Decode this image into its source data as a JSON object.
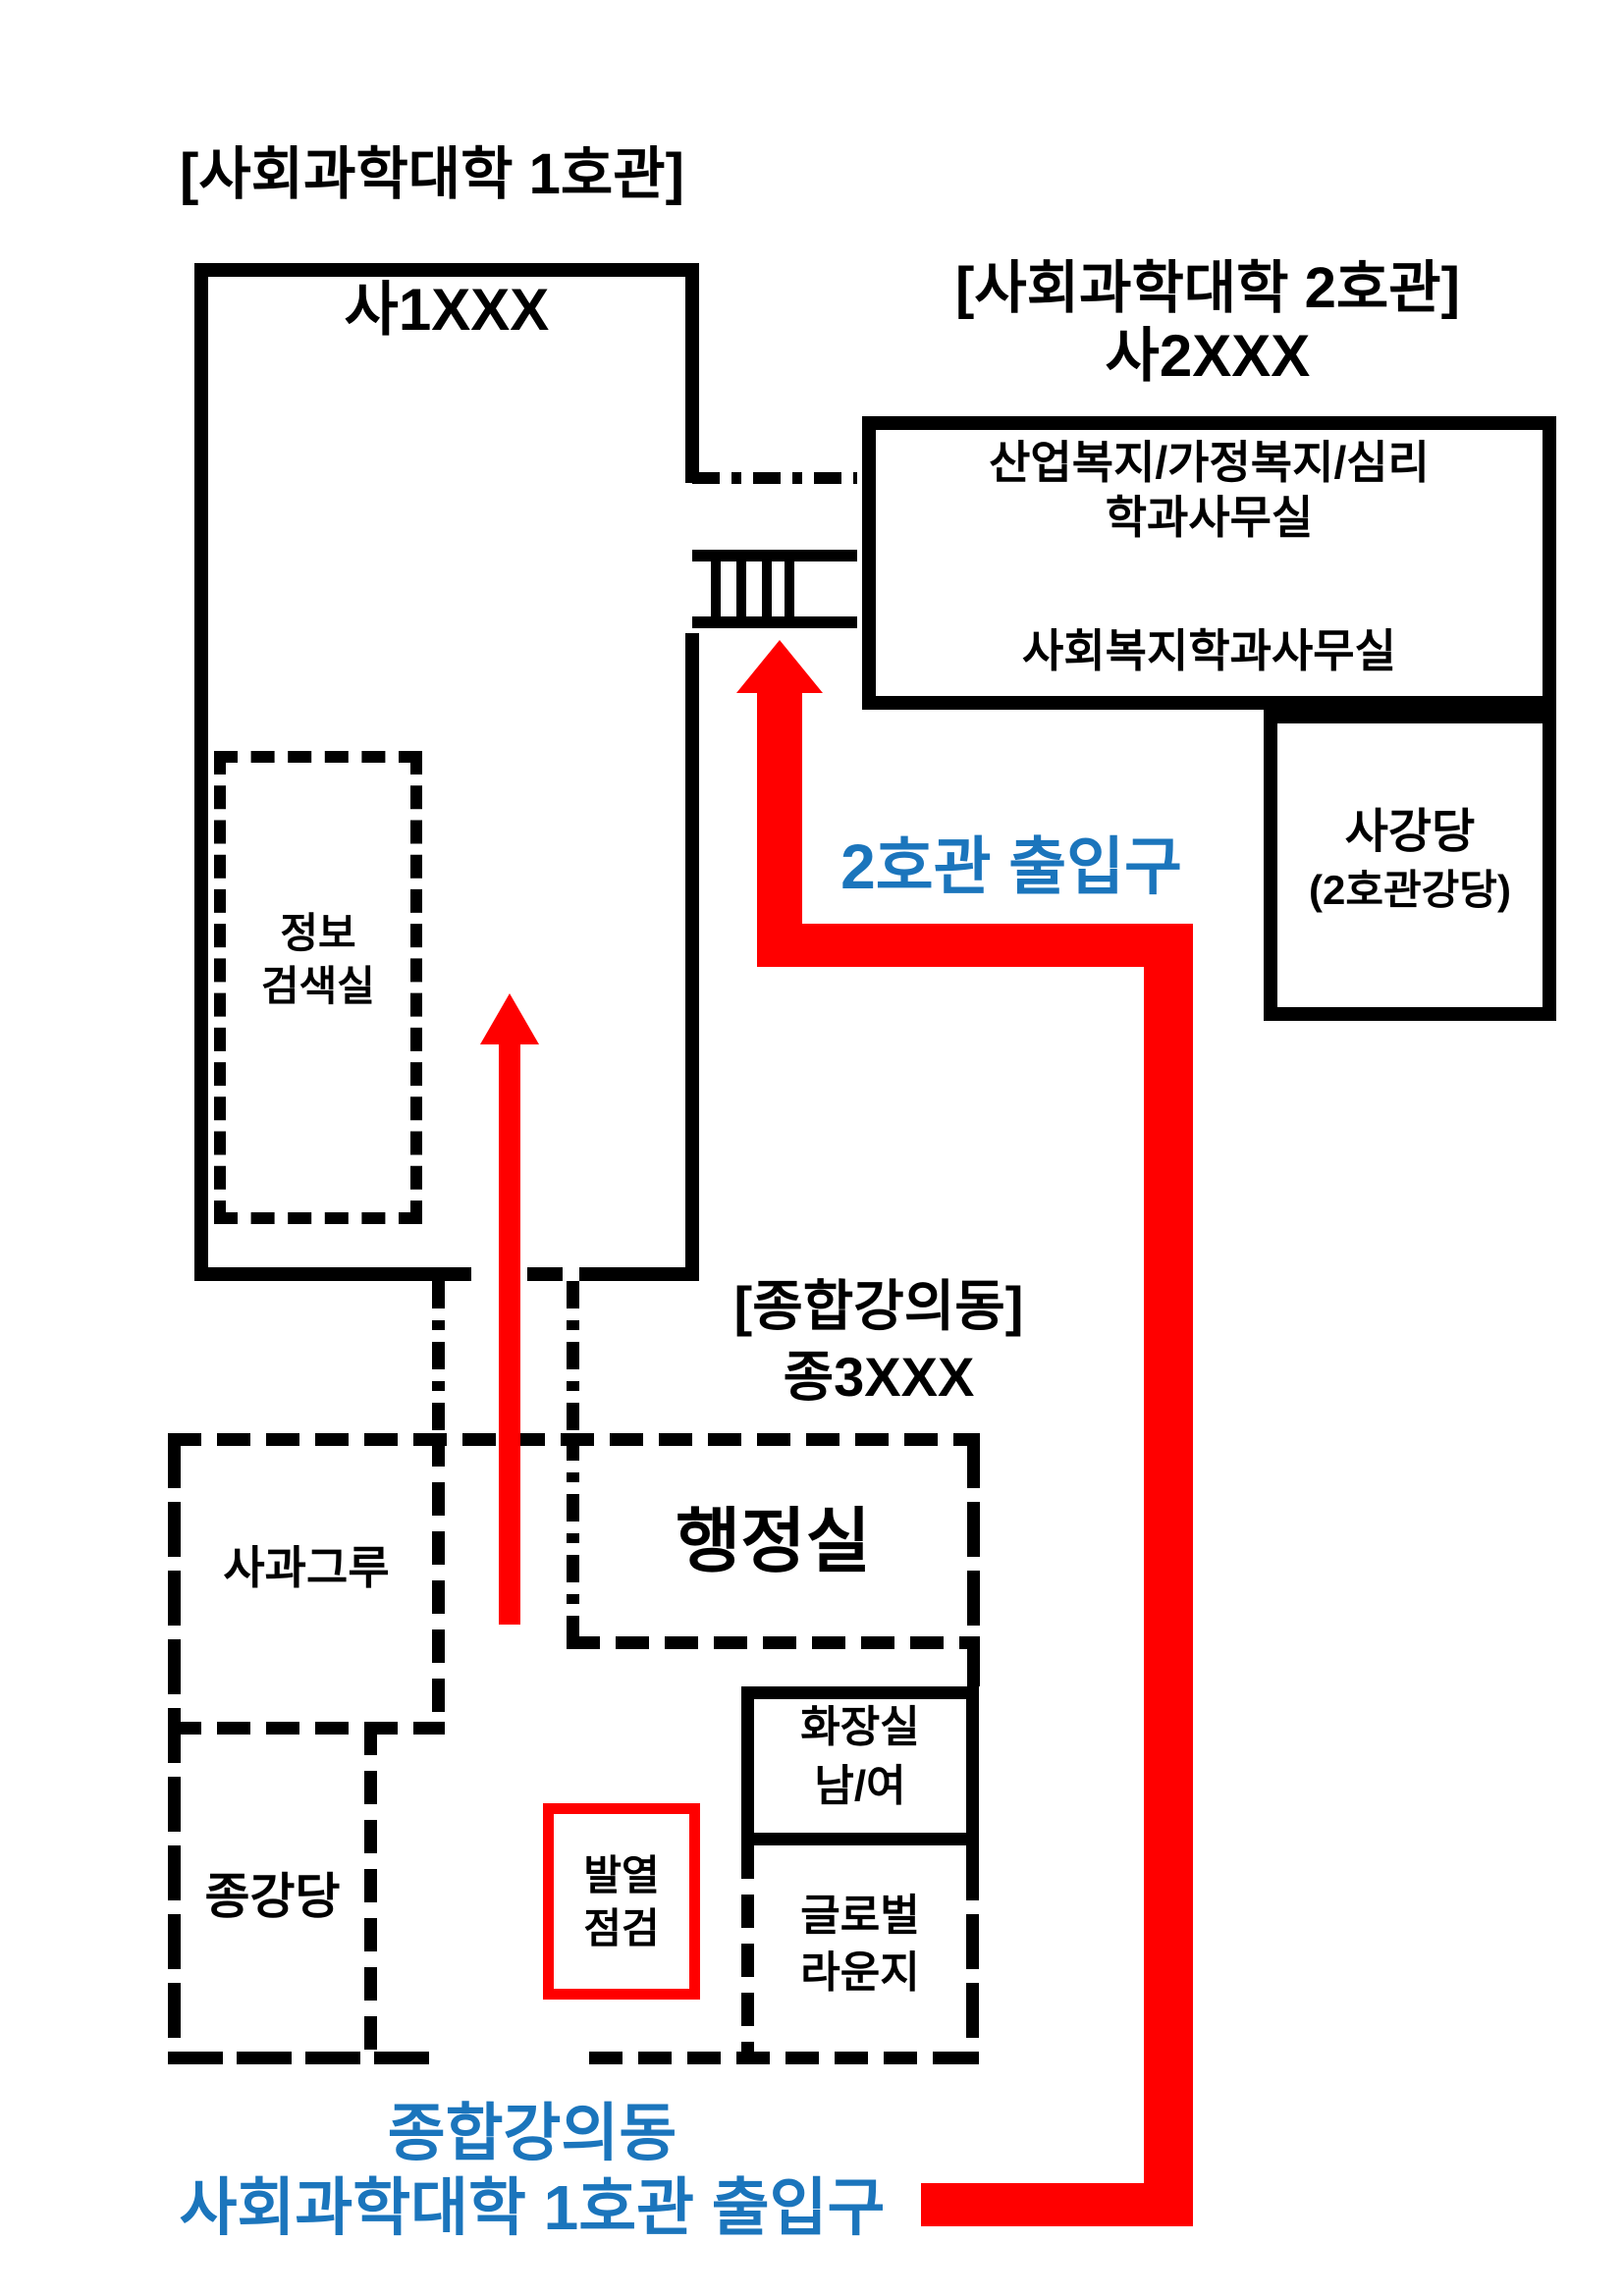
{
  "colors": {
    "black": "#000000",
    "red": "#ff0000",
    "blue": "#1b75bc",
    "white": "#ffffff"
  },
  "building1": {
    "title": "[사회과학대학 1호관]",
    "code": "사1XXX",
    "info_room_line1": "정보",
    "info_room_line2": "검색실"
  },
  "building2": {
    "title": "[사회과학대학 2호관]",
    "code": "사2XXX",
    "dept_office_line1": "산업복지/가정복지/심리",
    "dept_office_line2": "학과사무실",
    "welfare_office": "사회복지학과사무실",
    "auditorium_name": "사강당",
    "auditorium_sub": "(2호관강당)"
  },
  "lecture_hall": {
    "title": "[종합강의동]",
    "code": "종3XXX",
    "admin_office": "행정실",
    "sagwa_grove": "사과그루",
    "auditorium": "종강당",
    "restroom_line1": "화장실",
    "restroom_line2": "남/여",
    "fever_check_line1": "발열",
    "fever_check_line2": "점검",
    "lounge_line1": "글로벌",
    "lounge_line2": "라운지"
  },
  "routes": {
    "entrance_building2": "2호관 출입구",
    "entrance_building1_line1": "종합강의동",
    "entrance_building1_line2": "사회과학대학 1호관 출입구"
  }
}
